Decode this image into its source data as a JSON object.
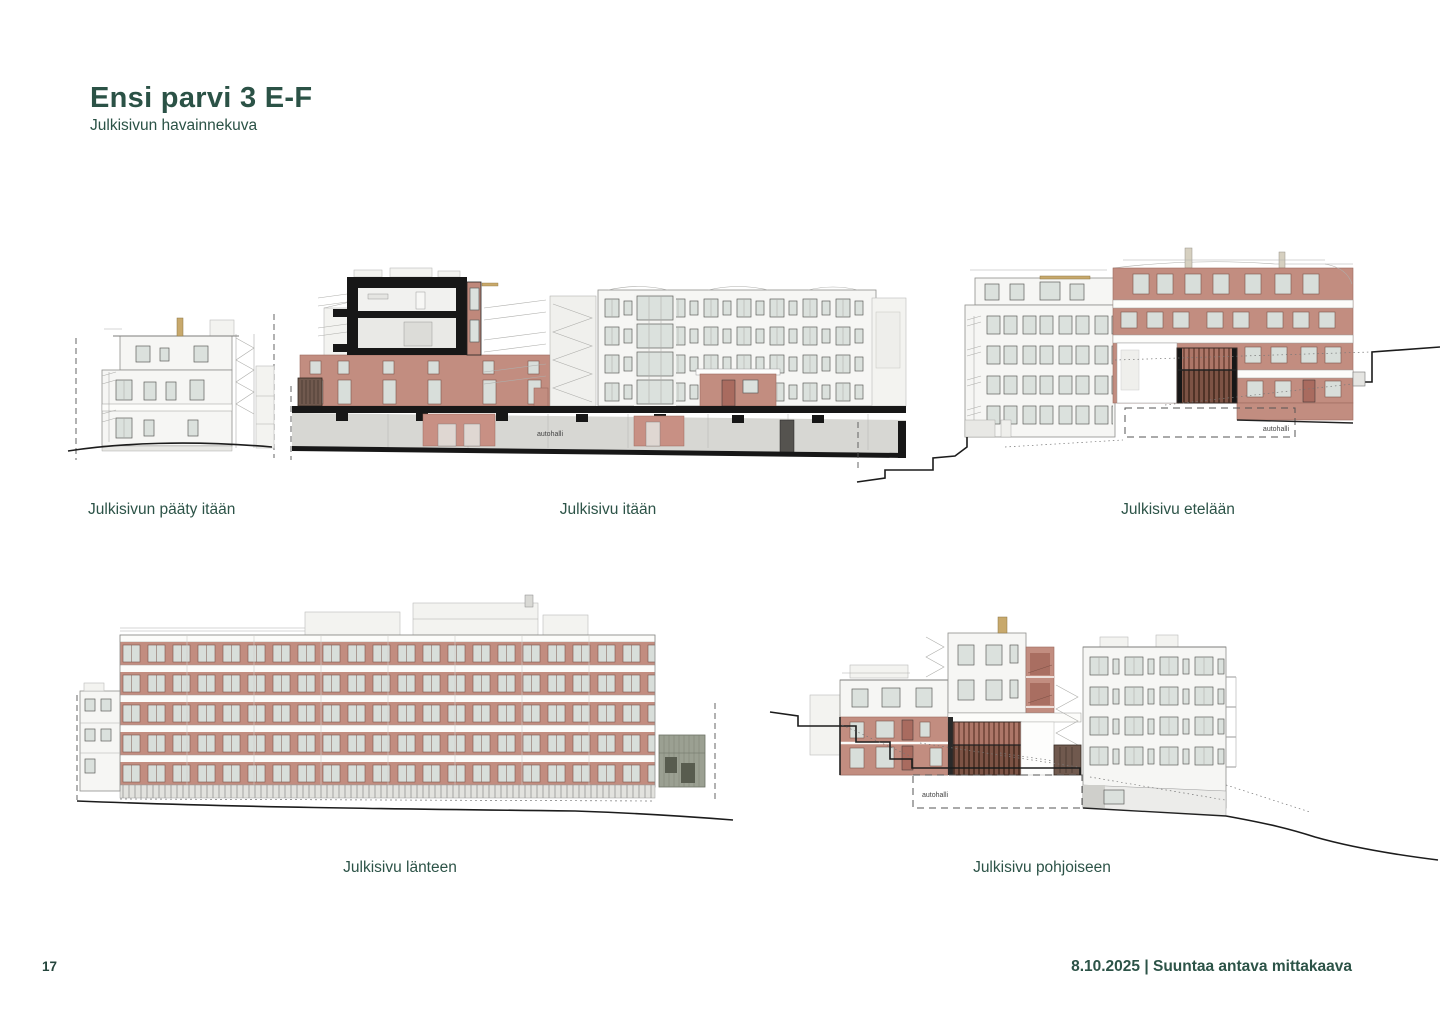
{
  "page": {
    "title": "Ensi parvi 3 E-F",
    "subtitle": "Julkisivun havainnekuva",
    "page_number": "17",
    "footer": "8.10.2025 | Suuntaa antava mittakaava"
  },
  "colors": {
    "accent_green": "#2b5246",
    "brick_red": "#c28d80",
    "section_black": "#171717",
    "garage_gray": "#d7d7d3",
    "glass": "#dbe1dd",
    "chimney_tan": "#c8a96c"
  },
  "drawings": {
    "east_end": {
      "caption": "Julkisivun pääty itään"
    },
    "east": {
      "caption": "Julkisivu itään",
      "garage_label": "autohalli"
    },
    "south": {
      "caption": "Julkisivu etelään",
      "garage_label": "autohalli"
    },
    "west": {
      "caption": "Julkisivu länteen"
    },
    "north": {
      "caption": "Julkisivu pohjoiseen",
      "garage_label": "autohalli"
    }
  }
}
